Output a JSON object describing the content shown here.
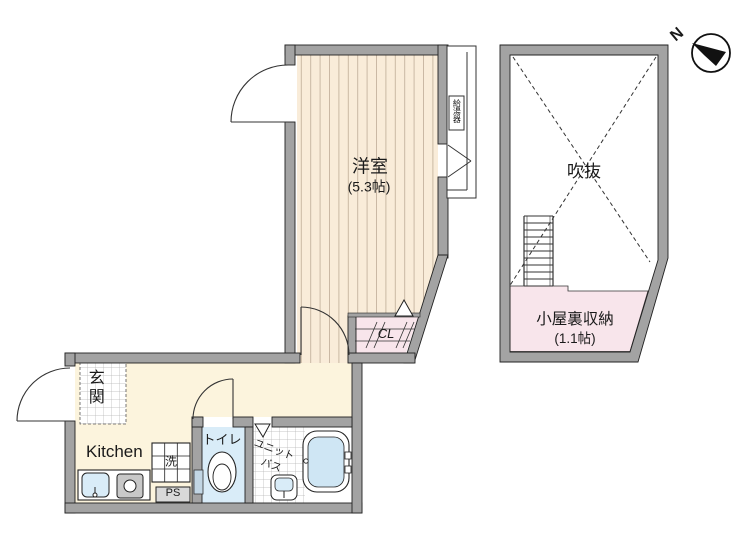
{
  "plan_title": "apartment-floor-plan",
  "labels": {
    "room": {
      "name": "洋室",
      "size": "(5.3帖)"
    },
    "void": {
      "name": "吹抜"
    },
    "attic": {
      "name": "小屋裏収納",
      "size": "(1.1帖)"
    },
    "kitchen": {
      "name": "Kitchen"
    },
    "entrance": {
      "name": "玄関"
    },
    "toilet": {
      "name": "トイレ"
    },
    "washer": {
      "name": "洗"
    },
    "pipe_space": {
      "name": "PS"
    },
    "unit_bath": {
      "line1": "ユニット",
      "line2": "バス"
    },
    "closet": {
      "name": "CL"
    },
    "water_heater": {
      "name": "給湯器"
    },
    "compass": {
      "north": "N"
    }
  },
  "colors": {
    "wall": "#a3a3a3",
    "wall_edge": "#222222",
    "wood_floor": "#f9ecd9",
    "wood_stripe": "#c9b8a3",
    "kitchen_floor": "#fcf4dd",
    "pink_floor": "#f8e5eb",
    "toilet_floor": "#d9ecf8",
    "bathtub_water": "#cfe6f4",
    "tile_line": "#b5b5b5"
  }
}
